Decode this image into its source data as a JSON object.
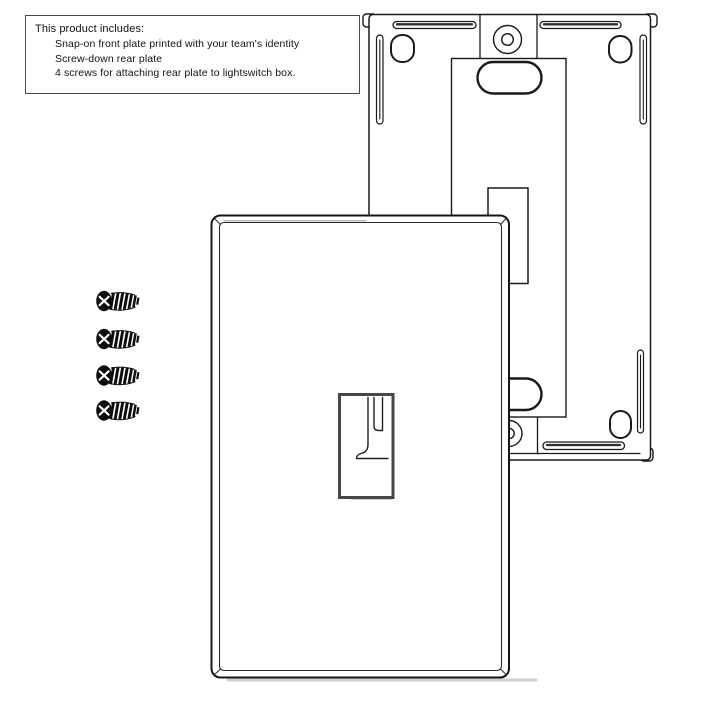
{
  "canvas": {
    "background": "#ffffff",
    "ink_color": "#1a1a1a",
    "shadow_color": "#9a9a9a"
  },
  "info_box": {
    "title": "This product includes:",
    "items": [
      "Snap-on front plate printed with your team's identity",
      "Screw-down rear plate",
      "4 screws for attaching rear plate to lightswitch box."
    ]
  },
  "diagram": {
    "type": "product-line-art",
    "parts": [
      {
        "id": "front-plate",
        "label": "Snap-on front plate"
      },
      {
        "id": "rear-plate",
        "label": "Screw-down rear plate"
      },
      {
        "id": "screws",
        "label": "Mounting screws",
        "count": 4
      }
    ]
  }
}
